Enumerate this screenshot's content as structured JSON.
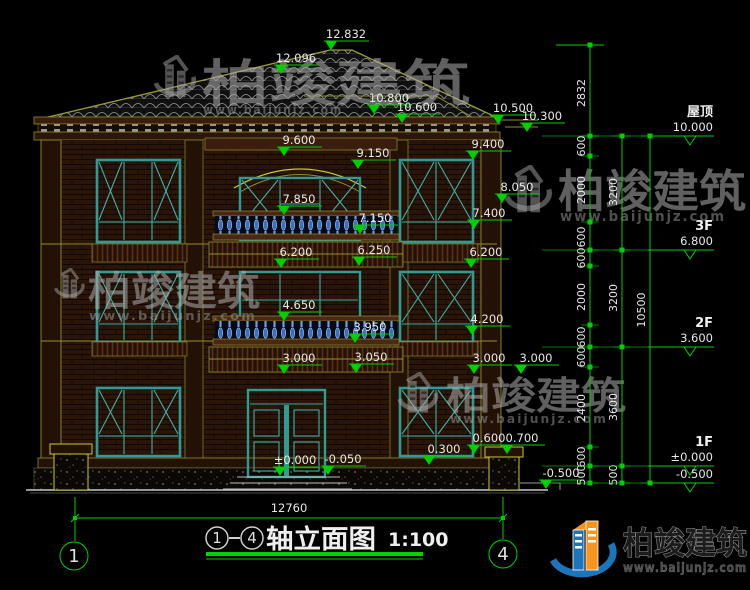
{
  "drawing_title": {
    "axis_from": "1",
    "axis_to": "4",
    "name": "轴立面图",
    "scale": "1:100"
  },
  "axis_bubbles": {
    "left": "1",
    "right": "4"
  },
  "bottom_dimension": {
    "total_width": "12760"
  },
  "brand": {
    "name": "柏竣建筑",
    "url": "www.baijunjz.com"
  },
  "floor_markers": [
    {
      "label": "屋顶",
      "elev": "10.000",
      "y": 136
    },
    {
      "label": "3F",
      "elev": "6.800",
      "y": 250
    },
    {
      "label": "2F",
      "elev": "3.600",
      "y": 347
    },
    {
      "label": "1F",
      "elev": "±0.000",
      "y": 466
    },
    {
      "label": "",
      "elev": "-0.500",
      "y": 483
    }
  ],
  "dim_chains": [
    {
      "x": 590,
      "ticks": [
        45,
        136
      ],
      "segments": [
        {
          "label": "2832",
          "y": 93
        }
      ]
    },
    {
      "x": 590,
      "ticks": [
        136,
        156,
        222,
        250,
        266,
        325,
        347,
        367,
        447,
        466,
        483
      ],
      "segments": [
        {
          "label": "600",
          "y": 146
        },
        {
          "label": "2000",
          "y": 190
        },
        {
          "label": "600",
          "y": 237
        },
        {
          "label": "600",
          "y": 258
        },
        {
          "label": "2000",
          "y": 297
        },
        {
          "label": "600",
          "y": 337
        },
        {
          "label": "600",
          "y": 357
        },
        {
          "label": "2400",
          "y": 408
        },
        {
          "label": "600",
          "y": 457
        },
        {
          "label": "500",
          "y": 475
        }
      ]
    },
    {
      "x": 622,
      "ticks": [
        136,
        250,
        347,
        466,
        483
      ],
      "segments": [
        {
          "label": "3200",
          "y": 192
        },
        {
          "label": "3200",
          "y": 298
        },
        {
          "label": "3600",
          "y": 407
        },
        {
          "label": "500",
          "y": 475
        }
      ]
    },
    {
      "x": 650,
      "ticks": [
        136,
        483
      ],
      "segments": [
        {
          "label": "10500",
          "y": 310
        }
      ]
    }
  ],
  "annotations": [
    {
      "t": "12.832",
      "x": 346,
      "y": 38
    },
    {
      "t": "12.096",
      "x": 296,
      "y": 62
    },
    {
      "t": "10.800",
      "x": 389,
      "y": 102
    },
    {
      "t": "10.600",
      "x": 417,
      "y": 111
    },
    {
      "t": "10.500",
      "x": 513,
      "y": 112
    },
    {
      "t": "10.300",
      "x": 542,
      "y": 120
    },
    {
      "t": "9.600",
      "x": 299,
      "y": 144
    },
    {
      "t": "9.150",
      "x": 373,
      "y": 157
    },
    {
      "t": "9.400",
      "x": 488,
      "y": 148
    },
    {
      "t": "8.050",
      "x": 517,
      "y": 191
    },
    {
      "t": "7.850",
      "x": 299,
      "y": 203
    },
    {
      "t": "7.150",
      "x": 375,
      "y": 222
    },
    {
      "t": "7.400",
      "x": 489,
      "y": 217
    },
    {
      "t": "6.200",
      "x": 296,
      "y": 256
    },
    {
      "t": "6.250",
      "x": 374,
      "y": 254
    },
    {
      "t": "6.200",
      "x": 486,
      "y": 256
    },
    {
      "t": "4.650",
      "x": 299,
      "y": 309
    },
    {
      "t": "4.200",
      "x": 487,
      "y": 323
    },
    {
      "t": "3.950",
      "x": 370,
      "y": 331
    },
    {
      "t": "3.000",
      "x": 299,
      "y": 362
    },
    {
      "t": "3.050",
      "x": 371,
      "y": 361
    },
    {
      "t": "3.000",
      "x": 489,
      "y": 362
    },
    {
      "t": "3.000",
      "x": 536,
      "y": 362
    },
    {
      "t": "0.300",
      "x": 444,
      "y": 453
    },
    {
      "t": "0.600",
      "x": 489,
      "y": 442
    },
    {
      "t": "0.700",
      "x": 522,
      "y": 442
    },
    {
      "t": "±0.000",
      "x": 295,
      "y": 464
    },
    {
      "t": "-0.050",
      "x": 343,
      "y": 463
    },
    {
      "t": "-0.500",
      "x": 561,
      "y": 477
    }
  ],
  "colors": {
    "background": "#000000",
    "dimension_green": "#00cf00",
    "cad_yellow": "#8f8f2e",
    "window_teal": "#2f9b94",
    "baluster_blue": "#3a6fc4",
    "text_white": "#e8e8e8",
    "watermark_gray": "#aaaaaa",
    "logo_blue": "#1b75bb",
    "logo_orange": "#f7941d"
  }
}
